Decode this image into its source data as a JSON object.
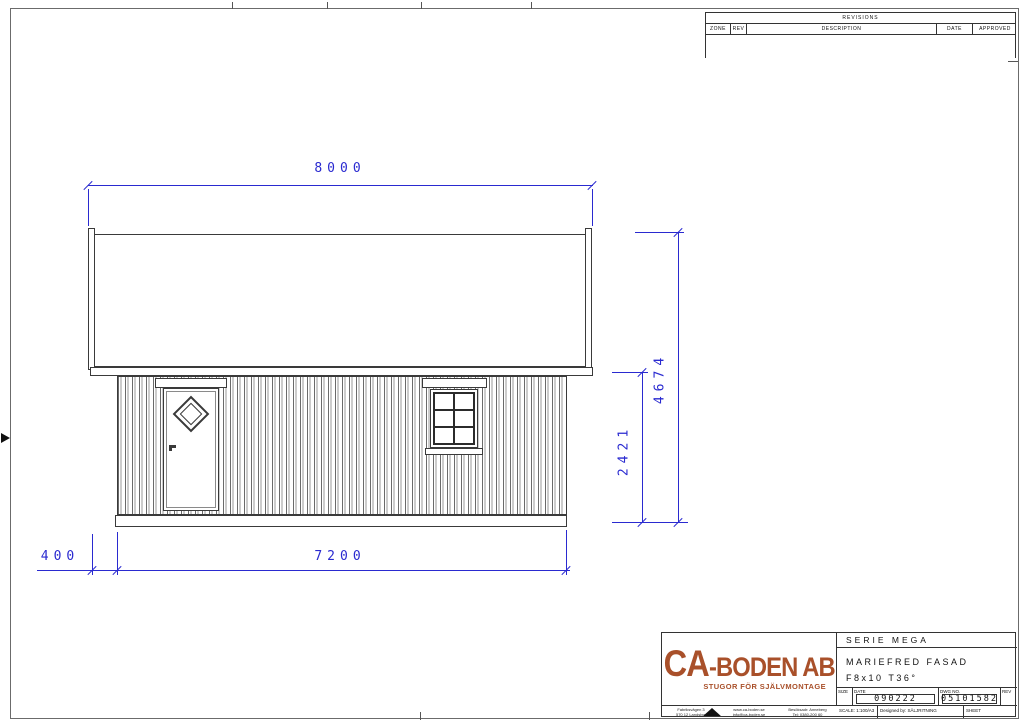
{
  "revisions": {
    "title": "REVISIONS",
    "columns": [
      "ZONE",
      "REV",
      "DESCRIPTION",
      "DATE",
      "APPROVED"
    ]
  },
  "dimensions": {
    "roof_width": "8000",
    "total_height": "4674",
    "wall_height": "2421",
    "overhang": "400",
    "wall_width": "7200"
  },
  "title_block": {
    "logo": {
      "name_ca": "CA",
      "name_rest": "-BODEN AB",
      "tagline": "STUGOR FÖR SJÄLVMONTAGE",
      "color": "#a9502a"
    },
    "series": "SERIE MEGA",
    "drawing_title": "MARIEFRED FASAD",
    "model": "F8x10 T36°",
    "labels": {
      "size": "SIZE",
      "date": "DATE",
      "dwg_no": "DWG NO.",
      "rev": "REV",
      "scale": "SCALE: 1:100/A3",
      "designed_by": "Designed by: SÄLJRITNING",
      "sheet": "SHEET"
    },
    "date_value": "090222",
    "dwg_no_value": "05101582",
    "address": [
      [
        "Fabriksvägen 3",
        "570 12 Landsbro"
      ],
      [
        "www.ca-boden.se",
        "info@ca-boden.se"
      ],
      [
        "Besöksadr: Anneberg",
        "Tel: 0380-200 60"
      ]
    ]
  },
  "accent_colors": {
    "dimension_blue": "#2a2ad0",
    "line_dark": "#3a3a3a"
  }
}
